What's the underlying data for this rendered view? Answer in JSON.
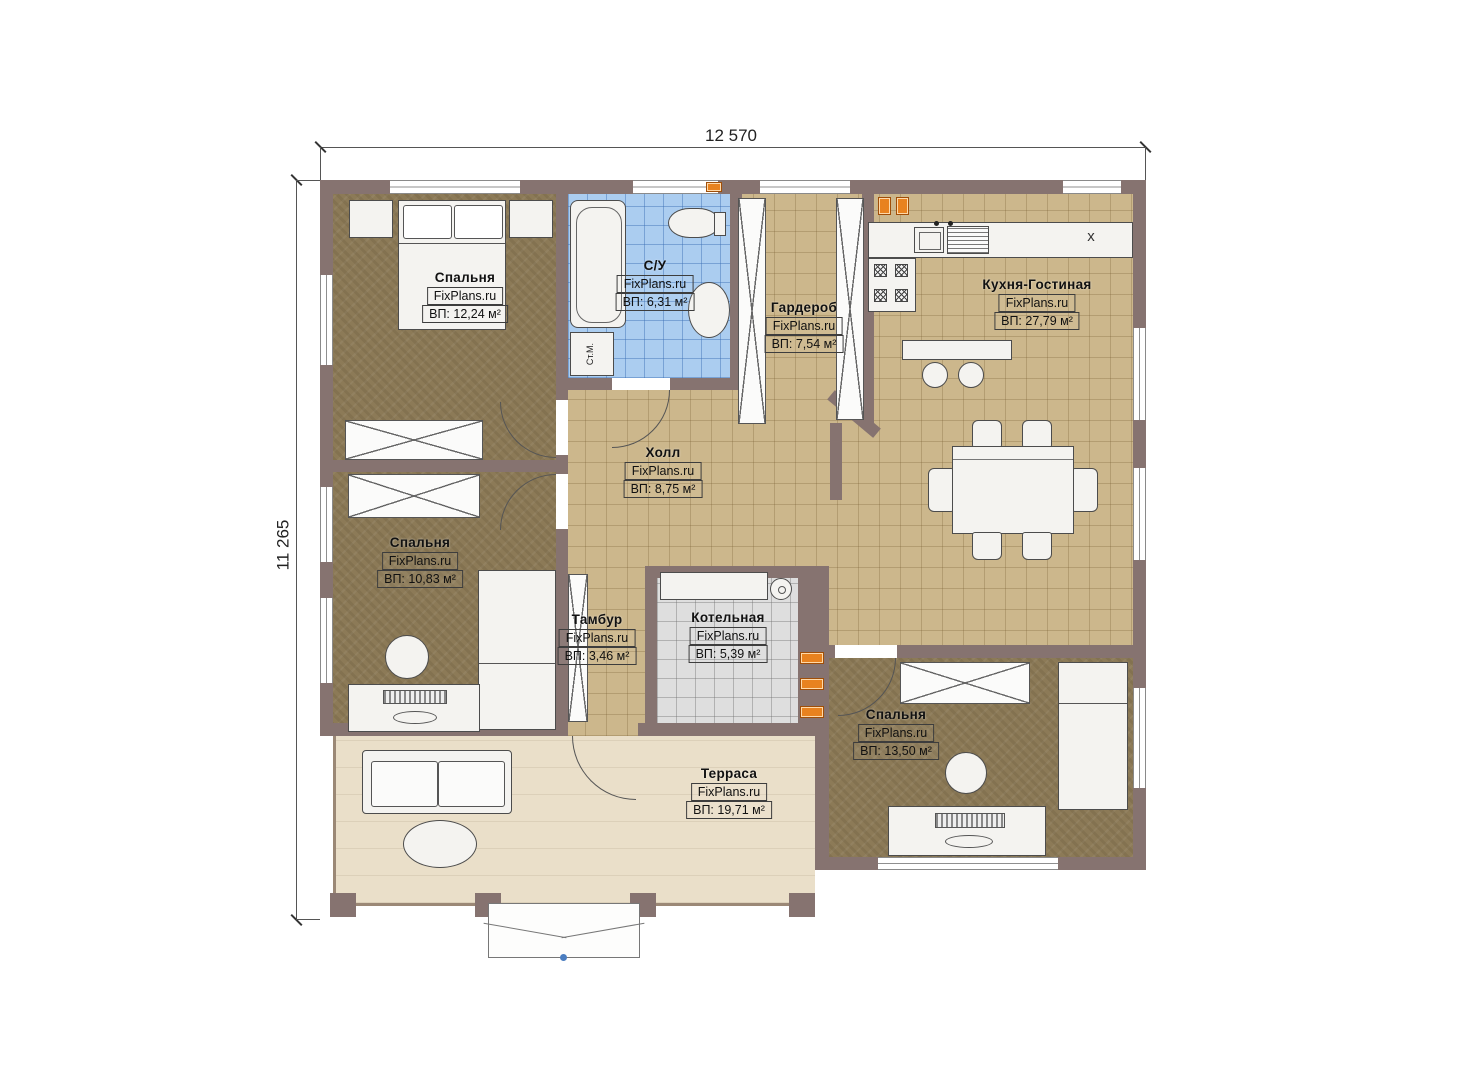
{
  "dimensions": {
    "width_label": "12 570",
    "height_label": "11 265"
  },
  "watermark": "FixPlans.ru",
  "rooms": [
    {
      "id": "bedroom-1",
      "name": "Спальня",
      "area": "ВП: 12,24 м²"
    },
    {
      "id": "bathroom",
      "name": "С/У",
      "area": "ВП: 6,31 м²"
    },
    {
      "id": "wardrobe-room",
      "name": "Гардероб",
      "area": "ВП: 7,54 м²"
    },
    {
      "id": "kitchen-living",
      "name": "Кухня-Гостиная",
      "area": "ВП: 27,79 м²"
    },
    {
      "id": "hall",
      "name": "Холл",
      "area": "ВП: 8,75 м²"
    },
    {
      "id": "bedroom-2",
      "name": "Спальня",
      "area": "ВП: 10,83 м²"
    },
    {
      "id": "vestibule",
      "name": "Тамбур",
      "area": "ВП: 3,46 м²"
    },
    {
      "id": "boiler-room",
      "name": "Котельная",
      "area": "ВП: 5,39 м²"
    },
    {
      "id": "bedroom-3",
      "name": "Спальня",
      "area": "ВП: 13,50 м²"
    },
    {
      "id": "terrace",
      "name": "Терраса",
      "area": "ВП: 19,71 м²"
    }
  ],
  "annotations": {
    "washing_machine": "Ст.М.",
    "fridge_mark": "x"
  },
  "colors": {
    "wall": "#867370",
    "floor_tan": "#ccb78c",
    "floor_brown": "#8c7a57",
    "floor_blue": "#abcdf0",
    "floor_gray": "#dedede",
    "floor_cream": "#eadfc9",
    "outlet": "#e8821f"
  }
}
